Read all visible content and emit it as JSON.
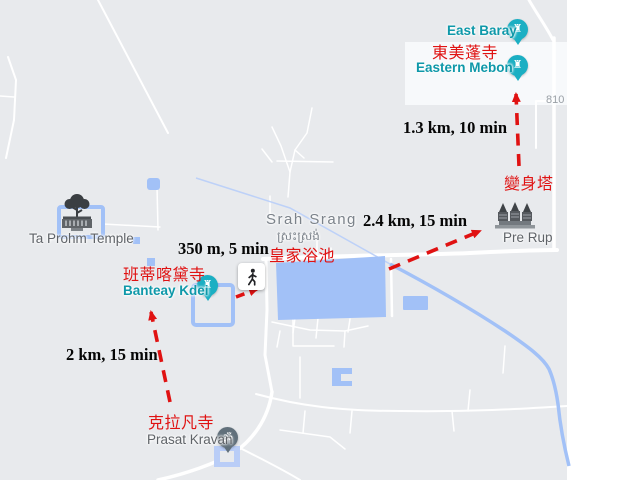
{
  "colors": {
    "map_background": "#e8eaed",
    "road_white": "#ffffff",
    "water_blue": "#a2c1f7",
    "route_red": "#e01212",
    "poi_pin_teal": "#1bafc3",
    "poi_text_teal": "#0e98a9",
    "poi_text_gray": "#5f6368",
    "worship_pin_gray": "#61707b"
  },
  "icons": {
    "temple_pin_glyph": "♜",
    "om_glyph": "ॐ"
  },
  "place_labels": {
    "east_baray": "East Baray",
    "eastern_mebon": "Eastern Mebon",
    "pre_rup": "Pre Rup",
    "srah_srang": "Srah Srang",
    "srah_srang_khmer": "ស្រះស្រង់",
    "banteay_kdei": "Banteay Kdei",
    "ta_prohm": "Ta Prohm Temple",
    "prasat_kravan": "Prasat Kravan",
    "road_810": "810"
  },
  "chinese_labels": {
    "eastern_mebon": "東美蓬寺",
    "pre_rup": "變身塔",
    "srah_srang": "皇家浴池",
    "banteay_kdei": "班蒂喀黛寺",
    "prasat_kravan": "克拉凡寺"
  },
  "routes": {
    "prerup_to_mebon": "1.3 km, 10 min",
    "srahsrang_to_prerup": "2.4 km, 15 min",
    "banteay_to_srahsrang": "350 m, 5 min",
    "kravan_to_banteay": "2 km, 15 min"
  }
}
